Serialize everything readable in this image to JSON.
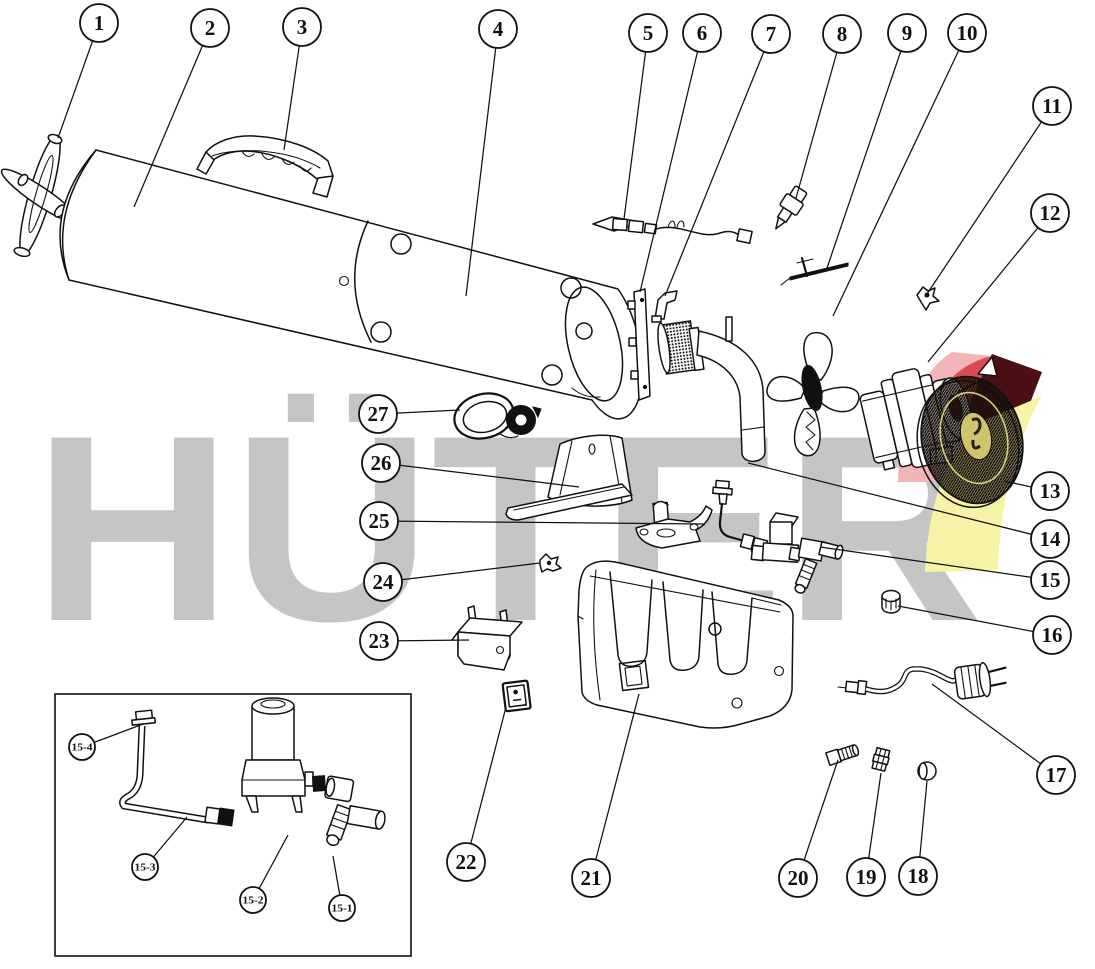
{
  "diagram": {
    "brand_watermark": "HÜTER",
    "watermark_color": "#c5c5c5",
    "line_color": "#111111",
    "logo_colors": {
      "pink": "#f3b4b8",
      "red": "#da4a52",
      "maroon": "#4a1014",
      "yellow": "#f6f3a6"
    },
    "callouts": [
      {
        "label": "1",
        "cx": 99,
        "cy": 23,
        "r": 19,
        "lx": 58,
        "ly": 138
      },
      {
        "label": "2",
        "cx": 210,
        "cy": 28,
        "r": 19,
        "lx": 134,
        "ly": 207
      },
      {
        "label": "3",
        "cx": 302,
        "cy": 27,
        "r": 19,
        "lx": 284,
        "ly": 150
      },
      {
        "label": "4",
        "cx": 498,
        "cy": 29,
        "r": 19,
        "lx": 466,
        "ly": 296
      },
      {
        "label": "5",
        "cx": 648,
        "cy": 33,
        "r": 19,
        "lx": 624,
        "ly": 219
      },
      {
        "label": "6",
        "cx": 702,
        "cy": 33,
        "r": 19,
        "lx": 640,
        "ly": 292
      },
      {
        "label": "7",
        "cx": 771,
        "cy": 34,
        "r": 19,
        "lx": 665,
        "ly": 296
      },
      {
        "label": "8",
        "cx": 842,
        "cy": 34,
        "r": 19,
        "lx": 796,
        "ly": 198
      },
      {
        "label": "9",
        "cx": 907,
        "cy": 33,
        "r": 19,
        "lx": 827,
        "ly": 268
      },
      {
        "label": "10",
        "cx": 967,
        "cy": 33,
        "r": 19,
        "lx": 833,
        "ly": 316
      },
      {
        "label": "11",
        "cx": 1052,
        "cy": 106,
        "r": 19,
        "lx": 925,
        "ly": 297
      },
      {
        "label": "12",
        "cx": 1050,
        "cy": 213,
        "r": 19,
        "lx": 928,
        "ly": 362
      },
      {
        "label": "13",
        "cx": 1050,
        "cy": 491,
        "r": 19,
        "lx": 1004,
        "ly": 481
      },
      {
        "label": "14",
        "cx": 1050,
        "cy": 539,
        "r": 19,
        "lx": 748,
        "ly": 463
      },
      {
        "label": "15",
        "cx": 1050,
        "cy": 580,
        "r": 19,
        "lx": 820,
        "ly": 547
      },
      {
        "label": "16",
        "cx": 1052,
        "cy": 635,
        "r": 19,
        "lx": 898,
        "ly": 606
      },
      {
        "label": "17",
        "cx": 1056,
        "cy": 775,
        "r": 19,
        "lx": 932,
        "ly": 684
      },
      {
        "label": "18",
        "cx": 918,
        "cy": 876,
        "r": 19,
        "lx": 927,
        "ly": 781
      },
      {
        "label": "19",
        "cx": 866,
        "cy": 877,
        "r": 19,
        "lx": 881,
        "ly": 773
      },
      {
        "label": "20",
        "cx": 798,
        "cy": 878,
        "r": 19,
        "lx": 838,
        "ly": 760
      },
      {
        "label": "21",
        "cx": 591,
        "cy": 878,
        "r": 19,
        "lx": 639,
        "ly": 694
      },
      {
        "label": "22",
        "cx": 466,
        "cy": 862,
        "r": 19,
        "lx": 506,
        "ly": 707
      },
      {
        "label": "23",
        "cx": 379,
        "cy": 641,
        "r": 19,
        "lx": 469,
        "ly": 640
      },
      {
        "label": "24",
        "cx": 383,
        "cy": 582,
        "r": 19,
        "lx": 540,
        "ly": 563
      },
      {
        "label": "25",
        "cx": 379,
        "cy": 521,
        "r": 19,
        "lx": 705,
        "ly": 524
      },
      {
        "label": "26",
        "cx": 381,
        "cy": 463,
        "r": 19,
        "lx": 579,
        "ly": 487
      },
      {
        "label": "27",
        "cx": 378,
        "cy": 414,
        "r": 19,
        "lx": 460,
        "ly": 410
      }
    ],
    "inset": {
      "callouts": [
        {
          "label": "15-4",
          "cx": 82,
          "cy": 747,
          "r": 13,
          "lx": 143,
          "ly": 724
        },
        {
          "label": "15-3",
          "cx": 145,
          "cy": 867,
          "r": 13,
          "lx": 187,
          "ly": 817
        },
        {
          "label": "15-2",
          "cx": 253,
          "cy": 900,
          "r": 13,
          "lx": 288,
          "ly": 835
        },
        {
          "label": "15-1",
          "cx": 342,
          "cy": 908,
          "r": 13,
          "lx": 333,
          "ly": 856
        }
      ]
    }
  }
}
